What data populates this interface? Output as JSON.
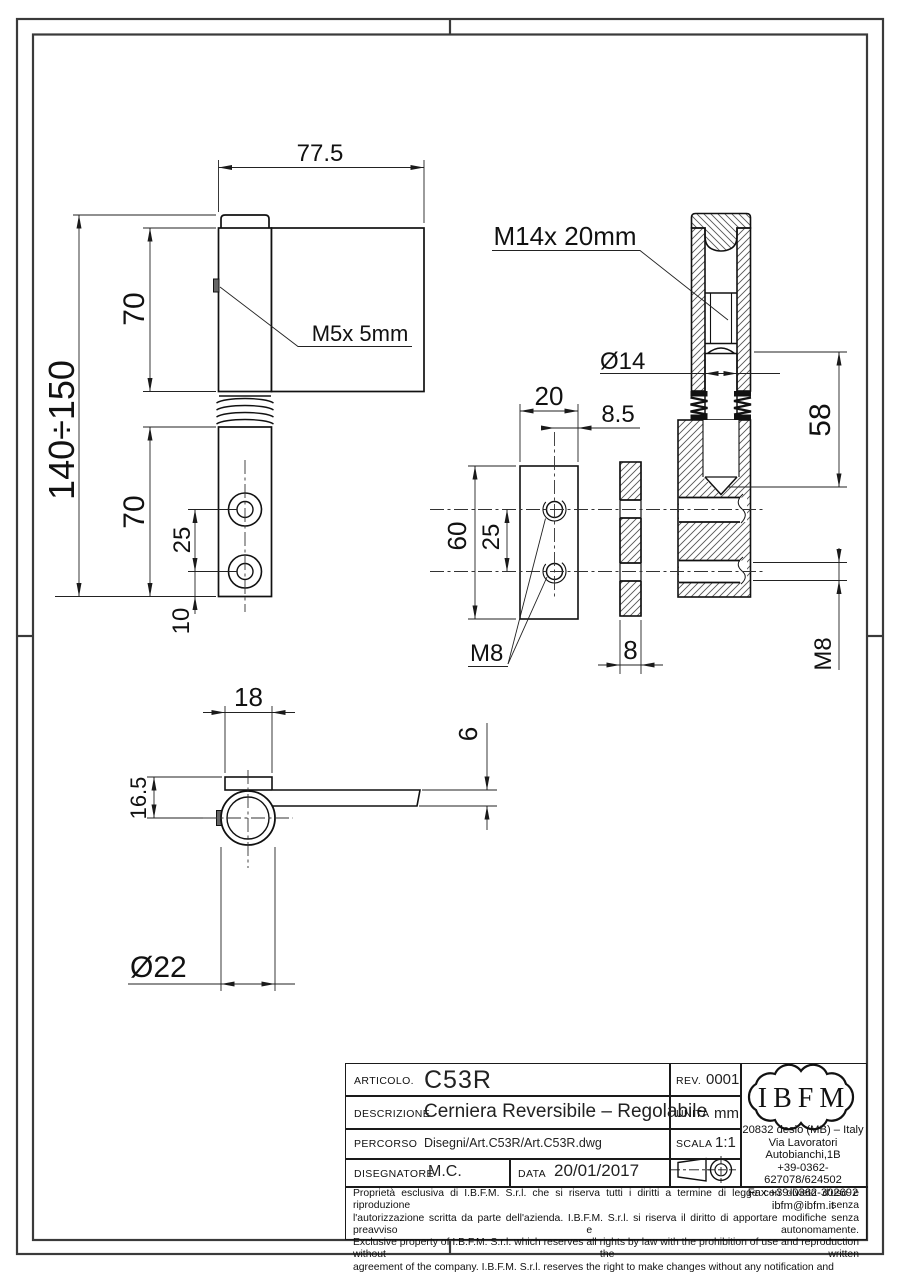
{
  "views": {
    "front": {
      "width": "77.5",
      "total_height": "140÷150",
      "upper_height": "70",
      "lower_height": "70",
      "hole_spacing": "25",
      "hole_offset": "10",
      "set_screw": "M5x 5mm"
    },
    "section": {
      "adjust_screw": "M14x 20mm",
      "pin_diameter": "Ø14",
      "pin_length": "58",
      "thread": "M8"
    },
    "plate": {
      "width": "20",
      "hole_edge_offset": "8.5",
      "height": "60",
      "hole_spacing": "25",
      "thread": "M8",
      "thickness": "8"
    },
    "top": {
      "tab_width": "18",
      "tab_depth": "16.5",
      "arm_thickness": "6",
      "barrel_diameter": "Ø22"
    }
  },
  "title_block": {
    "articolo": {
      "label": "ARTICOLO.",
      "value": "C53R"
    },
    "rev": {
      "label": "REV.",
      "value": "0001"
    },
    "descrizione": {
      "label": "DESCRIZIONE",
      "value": "Cerniera Reversibile – Regolabile"
    },
    "unita": {
      "label": "UNITÀ",
      "value": "mm"
    },
    "percorso": {
      "label": "PERCORSO",
      "value": "Disegni/Art.C53R/Art.C53R.dwg"
    },
    "scala": {
      "label": "SCALA",
      "value": "1:1"
    },
    "disegnatore": {
      "label": "DISEGNATORE",
      "value": "M.C."
    },
    "data": {
      "label": "DATA",
      "value": "20/01/2017"
    },
    "company": {
      "logo": "IBFM",
      "address": [
        "20832 desio (MB) – Italy",
        "Via Lavoratori Autobianchi,1B",
        "+39-0362-627078/624502",
        "Fax +39-0362-302692",
        "ibfm@ibfm.it"
      ]
    },
    "disclaimer": [
      "Proprietà esclusiva di I.B.F.M. S.r.l. che si riserva tutti i diritti a termine di legge con divieto d'uso e riproduzione senza",
      "l'autorizzazione scritta da parte dell'azienda. I.B.F.M. S.r.l. si riserva il diritto di apportare modifiche senza preavviso e autonomamente.",
      "Exclusive property of I.B.F.M. S.r.l. which reserves all rights by law with the prohibition of use and reproduction without the written",
      "agreement of the company. I.B.F.M. S.r.l. reserves the right to make changes without any notification and independently."
    ]
  }
}
